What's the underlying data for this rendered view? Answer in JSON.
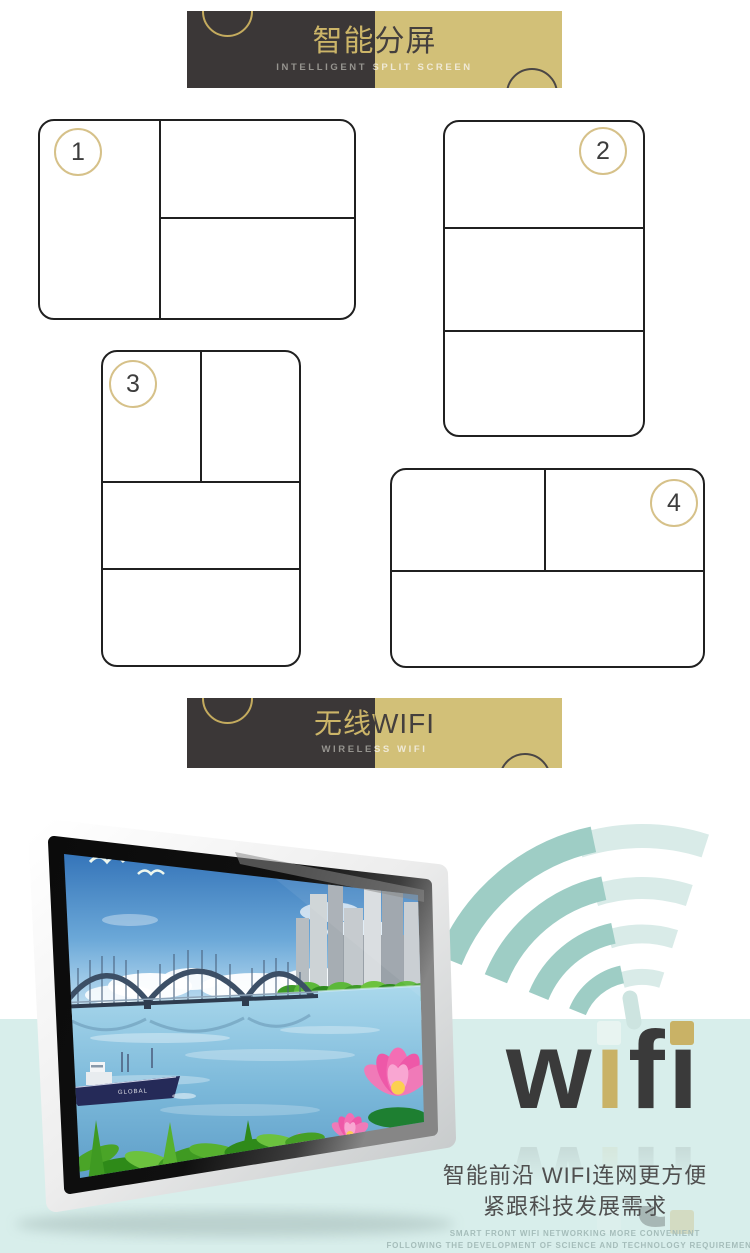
{
  "banners": {
    "split_screen": {
      "title": "智能分屏",
      "subtitle": "INTELLIGENT SPLIT SCREEN"
    },
    "wireless": {
      "title": "无线WIFI",
      "subtitle": "WIRELESS WIFI"
    }
  },
  "split_layouts": [
    {
      "number": "1"
    },
    {
      "number": "2"
    },
    {
      "number": "3"
    },
    {
      "number": "4"
    }
  ],
  "wifi_wordmark": {
    "word": "wifi",
    "letters": [
      {
        "ch": "w"
      },
      {
        "ch": "ı"
      },
      {
        "ch": "f"
      },
      {
        "ch": "ı"
      }
    ]
  },
  "monitor": {
    "hull_label": "GLOBAL"
  },
  "caption": {
    "line1": "智能前沿 WIFI连网更方便",
    "line2": "紧跟科技发展需求",
    "small1": "SMART FRONT WIFI NETWORKING MORE CONVENIENT",
    "small2": "FOLLOWING THE DEVELOPMENT OF SCIENCE AND TECHNOLOGY REQUIREMENTS"
  },
  "colors": {
    "banner_dark": "#3b3737",
    "banner_gold": "#d2c078",
    "band_cyan": "#d8eeeb",
    "arc_dark": "#9ecdc5",
    "arc_light": "#d9ebe8",
    "wordmark_dark": "#3a3a3a",
    "wordmark_gold": "#c9b266"
  }
}
